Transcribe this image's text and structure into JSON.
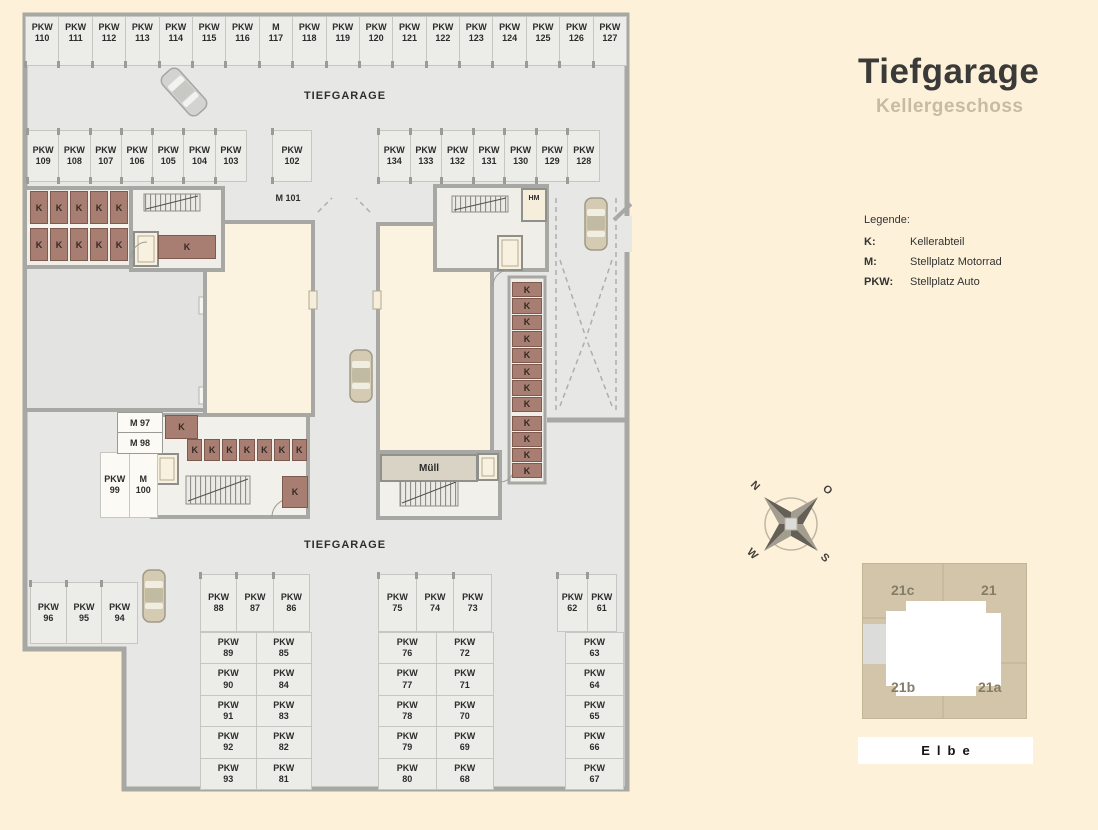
{
  "panel": {
    "title": "Tiefgarage",
    "subtitle": "Kellergeschoss"
  },
  "legend": {
    "heading": "Legende:",
    "items": [
      {
        "key": "K:",
        "label": "Kellerabteil"
      },
      {
        "key": "M:",
        "label": "Stellplatz Motorrad"
      },
      {
        "key": "PKW:",
        "label": "Stellplatz Auto"
      }
    ]
  },
  "compass": {
    "n": "N",
    "o": "O",
    "s": "S",
    "w": "W"
  },
  "siteplan": {
    "q": [
      "21c",
      "21",
      "21b",
      "21a"
    ],
    "river": "Elbe"
  },
  "plan": {
    "labels": {
      "tiefgarage_top": "TIEFGARAGE",
      "tiefgarage_bottom": "TIEFGARAGE",
      "m101": "M 101",
      "hm": "HM",
      "muell": "Müll",
      "m97": "M 97",
      "m98": "M 98"
    },
    "k_letter": "K",
    "k": {
      "left_top": 5,
      "left_bottom": 5,
      "left_wide": 1,
      "core_left_single": 1,
      "core_left_row": 7,
      "core_left_single2": 1,
      "right_top": 8,
      "right_bottom": 4
    },
    "spots": {
      "top_row": [
        {
          "t": "PKW",
          "n": "110"
        },
        {
          "t": "PKW",
          "n": "111"
        },
        {
          "t": "PKW",
          "n": "112"
        },
        {
          "t": "PKW",
          "n": "113"
        },
        {
          "t": "PKW",
          "n": "114"
        },
        {
          "t": "PKW",
          "n": "115"
        },
        {
          "t": "PKW",
          "n": "116"
        },
        {
          "t": "M",
          "n": "117"
        },
        {
          "t": "PKW",
          "n": "118"
        },
        {
          "t": "PKW",
          "n": "119"
        },
        {
          "t": "PKW",
          "n": "120"
        },
        {
          "t": "PKW",
          "n": "121"
        },
        {
          "t": "PKW",
          "n": "122"
        },
        {
          "t": "PKW",
          "n": "123"
        },
        {
          "t": "PKW",
          "n": "124"
        },
        {
          "t": "PKW",
          "n": "125"
        },
        {
          "t": "PKW",
          "n": "126"
        },
        {
          "t": "PKW",
          "n": "127"
        }
      ],
      "mid_left": [
        {
          "t": "PKW",
          "n": "109"
        },
        {
          "t": "PKW",
          "n": "108"
        },
        {
          "t": "PKW",
          "n": "107"
        },
        {
          "t": "PKW",
          "n": "106"
        },
        {
          "t": "PKW",
          "n": "105"
        },
        {
          "t": "PKW",
          "n": "104"
        },
        {
          "t": "PKW",
          "n": "103"
        }
      ],
      "mid_single": [
        {
          "t": "PKW",
          "n": "102"
        }
      ],
      "mid_right": [
        {
          "t": "PKW",
          "n": "134"
        },
        {
          "t": "PKW",
          "n": "133"
        },
        {
          "t": "PKW",
          "n": "132"
        },
        {
          "t": "PKW",
          "n": "131"
        },
        {
          "t": "PKW",
          "n": "130"
        },
        {
          "t": "PKW",
          "n": "129"
        },
        {
          "t": "PKW",
          "n": "128"
        }
      ],
      "row_96": [
        {
          "t": "PKW",
          "n": "96"
        },
        {
          "t": "PKW",
          "n": "95"
        },
        {
          "t": "PKW",
          "n": "94"
        }
      ],
      "block_a_top": [
        {
          "t": "PKW",
          "n": "88"
        },
        {
          "t": "PKW",
          "n": "87"
        },
        {
          "t": "PKW",
          "n": "86"
        }
      ],
      "block_a_grid": [
        {
          "t": "PKW",
          "n": "89"
        },
        {
          "t": "PKW",
          "n": "85"
        },
        {
          "t": "PKW",
          "n": "90"
        },
        {
          "t": "PKW",
          "n": "84"
        },
        {
          "t": "PKW",
          "n": "91"
        },
        {
          "t": "PKW",
          "n": "83"
        },
        {
          "t": "PKW",
          "n": "92"
        },
        {
          "t": "PKW",
          "n": "82"
        },
        {
          "t": "PKW",
          "n": "93"
        },
        {
          "t": "PKW",
          "n": "81"
        }
      ],
      "block_b_top": [
        {
          "t": "PKW",
          "n": "75"
        },
        {
          "t": "PKW",
          "n": "74"
        },
        {
          "t": "PKW",
          "n": "73"
        }
      ],
      "block_b_grid": [
        {
          "t": "PKW",
          "n": "76"
        },
        {
          "t": "PKW",
          "n": "72"
        },
        {
          "t": "PKW",
          "n": "77"
        },
        {
          "t": "PKW",
          "n": "71"
        },
        {
          "t": "PKW",
          "n": "78"
        },
        {
          "t": "PKW",
          "n": "70"
        },
        {
          "t": "PKW",
          "n": "79"
        },
        {
          "t": "PKW",
          "n": "69"
        },
        {
          "t": "PKW",
          "n": "80"
        },
        {
          "t": "PKW",
          "n": "68"
        }
      ],
      "block_c_top": [
        {
          "t": "PKW",
          "n": "62"
        },
        {
          "t": "PKW",
          "n": "61"
        }
      ],
      "block_c_col": [
        {
          "t": "PKW",
          "n": "63"
        },
        {
          "t": "PKW",
          "n": "64"
        },
        {
          "t": "PKW",
          "n": "65"
        },
        {
          "t": "PKW",
          "n": "66"
        },
        {
          "t": "PKW",
          "n": "67"
        }
      ],
      "moto_pair": [
        {
          "t": "PKW",
          "n": "99"
        },
        {
          "t": "M",
          "n": "100"
        }
      ]
    }
  }
}
